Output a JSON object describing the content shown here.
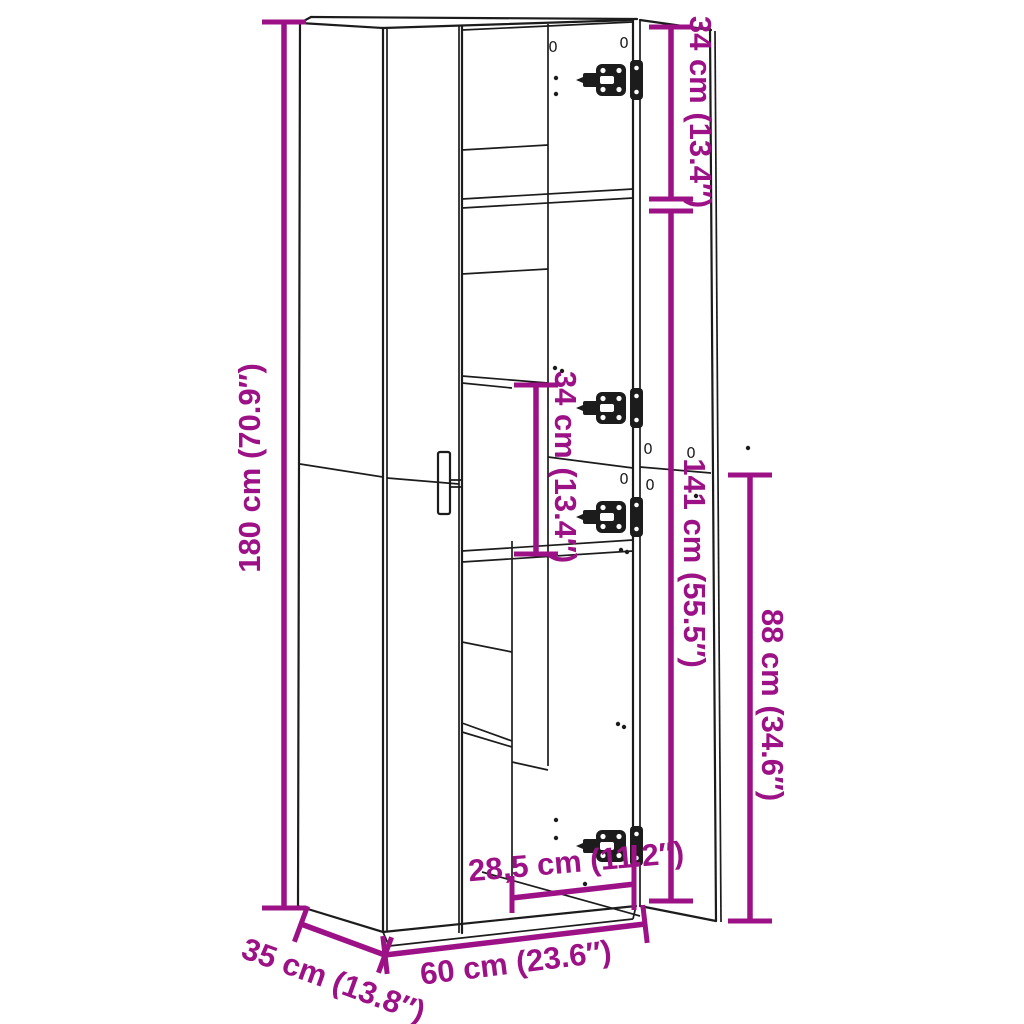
{
  "colors": {
    "dimension_accent": "#9C1286",
    "line_art": "#1C1C1C",
    "background": "#FFFFFF"
  },
  "dimensions": {
    "overall_height": {
      "label": "180 cm (70.9″)"
    },
    "top_section_height": {
      "label": "34 cm (13.4″)"
    },
    "interior_shelf_height": {
      "label": "34 cm (13.4″)"
    },
    "door_height": {
      "label": "141 cm (55.5″)"
    },
    "lower_section_height": {
      "label": "88 cm (34.6″)"
    },
    "interior_width": {
      "label": "28,5 cm (11.2″)"
    },
    "overall_width": {
      "label": "60 cm (23.6″)"
    },
    "overall_depth": {
      "label": "35 cm (13.8″)"
    }
  },
  "markers": {
    "drill_hole": "0"
  }
}
